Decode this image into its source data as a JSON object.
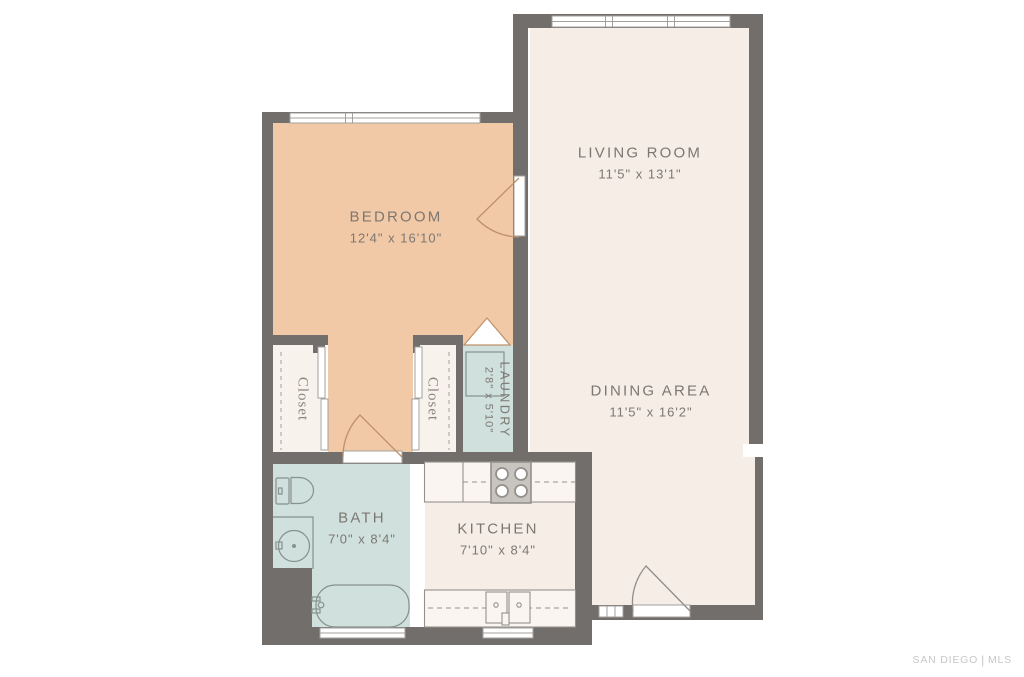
{
  "palette": {
    "wall": "#716e6b",
    "floor_cream": "#f6ede7",
    "floor_peach": "#f1c9a7",
    "floor_blue": "#cfe0dd",
    "floor_closet": "#f8f2ec",
    "counter_fill": "#faf5f0",
    "stove_fill": "#c8c4c0",
    "fixture_stroke": "#94918d",
    "bath_fixture": "#87918f",
    "door_tan": "#bd9068",
    "door_gray": "#908d8a",
    "window_stroke": "#a3a09c",
    "label": "#7d7772",
    "closet_label": "#8b8580",
    "watermark": "#c9c7c5"
  },
  "rooms": {
    "living": {
      "name": "LIVING ROOM",
      "dims": "11'5\" x 13'1\""
    },
    "bedroom": {
      "name": "BEDROOM",
      "dims": "12'4\" x 16'10\""
    },
    "dining": {
      "name": "DINING AREA",
      "dims": "11'5\" x 16'2\""
    },
    "bath": {
      "name": "BATH",
      "dims": "7'0\" x 8'4\""
    },
    "kitchen": {
      "name": "KITCHEN",
      "dims": "7'10\" x 8'4\""
    },
    "laundry": {
      "name": "LAUNDRY",
      "dims": "2'8\" x 5'10\""
    },
    "closet_left": {
      "name": "Closet"
    },
    "closet_right": {
      "name": "Closet"
    }
  },
  "watermark": {
    "left": "SAN DIEGO",
    "divider": "|",
    "right": "MLS"
  }
}
